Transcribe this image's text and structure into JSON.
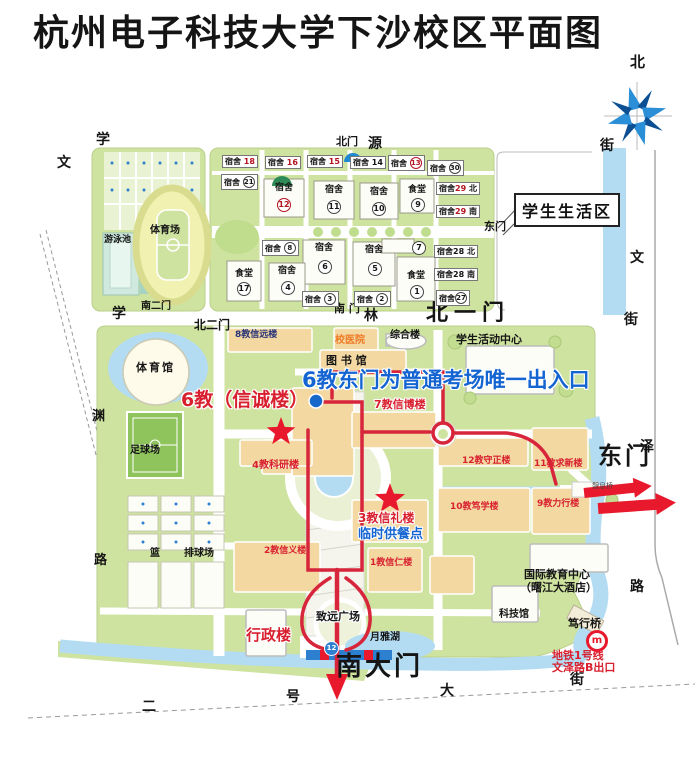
{
  "title": "杭州电子科技大学下沙校区平面图",
  "compass": {
    "north": "北"
  },
  "streets": {
    "xueyuan": [
      "学",
      "源",
      "街"
    ],
    "xuelin": [
      "学",
      "林",
      "街"
    ],
    "wenyuan": [
      "文",
      "渊",
      "路"
    ],
    "wenze": [
      "文",
      "泽",
      "路"
    ],
    "erhao_dajie": [
      "二",
      "号",
      "大",
      "街"
    ]
  },
  "gates": {
    "north": "北门",
    "north_first": "北一门",
    "north_second": "北二门",
    "south_second": "南二门",
    "dorm_east": "东门",
    "dorm_south": "南 门",
    "east": "东门",
    "south_main": "南大门"
  },
  "sports": {
    "stadium": "体育场",
    "pool": "游泳池",
    "gym": "体育馆",
    "soccer": "足球场",
    "courts_lan": "篮",
    "courts_pai": "排球场"
  },
  "dorm_zone": {
    "label": "学生生活区",
    "boxes": {
      "su18": {
        "n": "宿舍",
        "v": "18"
      },
      "su16": {
        "n": "宿舍",
        "v": "16"
      },
      "su15": {
        "n": "宿舍",
        "v": "15"
      },
      "su14": {
        "n": "宿舍",
        "v": "14"
      },
      "su13": {
        "n": "宿舍",
        "v": "13"
      },
      "su30": {
        "n": "宿舍",
        "v": "30"
      },
      "su21": {
        "n": "宿舍",
        "v": "21"
      },
      "su12": {
        "n": "宿舍",
        "v": "12"
      },
      "su11": {
        "n": "宿舍",
        "v": "11"
      },
      "su10": {
        "n": "宿舍",
        "v": "10"
      },
      "c9": {
        "n": "食堂",
        "v": "9"
      },
      "su29n": {
        "n": "宿舍",
        "v": "29",
        "s": "北"
      },
      "su29s": {
        "n": "宿舍",
        "v": "29",
        "s": "南"
      },
      "c17": {
        "n": "食堂",
        "v": "17"
      },
      "su8": {
        "n": "宿舍",
        "v": "8"
      },
      "su7": {
        "v": "7"
      },
      "su6": {
        "n": "宿舍",
        "v": "6"
      },
      "su5": {
        "n": "宿舍",
        "v": "5"
      },
      "su4": {
        "n": "宿舍",
        "v": "4"
      },
      "c1": {
        "n": "食堂",
        "v": "1"
      },
      "su3": {
        "n": "宿舍",
        "v": "3"
      },
      "su2": {
        "n": "宿舍",
        "v": "2"
      },
      "su28n": {
        "n": "宿舍",
        "v": "28",
        "s": "北"
      },
      "su28s": {
        "n": "宿舍",
        "v": "28",
        "s": "南"
      },
      "su27": {
        "n": "宿舍",
        "v": "27"
      }
    }
  },
  "buildings": {
    "b8": "8教信远楼",
    "hospital": "校医院",
    "library": "图 书 馆",
    "complex": "综合楼",
    "activity": "学生活动中心",
    "b6": "6教（信诚楼）",
    "b7": "7教信博楼",
    "b4": "4教科研楼",
    "b12": "12教守正楼",
    "b11": "11教求新楼",
    "b10": "10教笃学楼",
    "b9": "9教力行楼",
    "b3": "3教信礼楼",
    "b2": "2教信义楼",
    "b1": "1教信仁楼",
    "intl_line1": "国际教育中心",
    "intl_line2": "（曙江大酒店）",
    "science": "科技馆",
    "admin": "行政楼"
  },
  "landmarks": {
    "plaza": "致远广场",
    "lake": "月雅湖",
    "duxing_bridge": "笃行桥",
    "qixi_bridge": "憩息桥"
  },
  "notes": {
    "exam_entrance": "6教东门为普通考场唯一出入口",
    "meal_point": "临时供餐点"
  },
  "metro": {
    "icon": "m",
    "line1": "地铁1号线",
    "line2": "文泽路B出口",
    "stop_num": "12"
  },
  "colors": {
    "red_text": "#d8202f",
    "blue_text": "#1464d2",
    "orange_text": "#ee7a24",
    "route": "#d7263c",
    "land": "#cfe3a0",
    "water": "#b3dcf2",
    "building": "#f3d8a2"
  }
}
